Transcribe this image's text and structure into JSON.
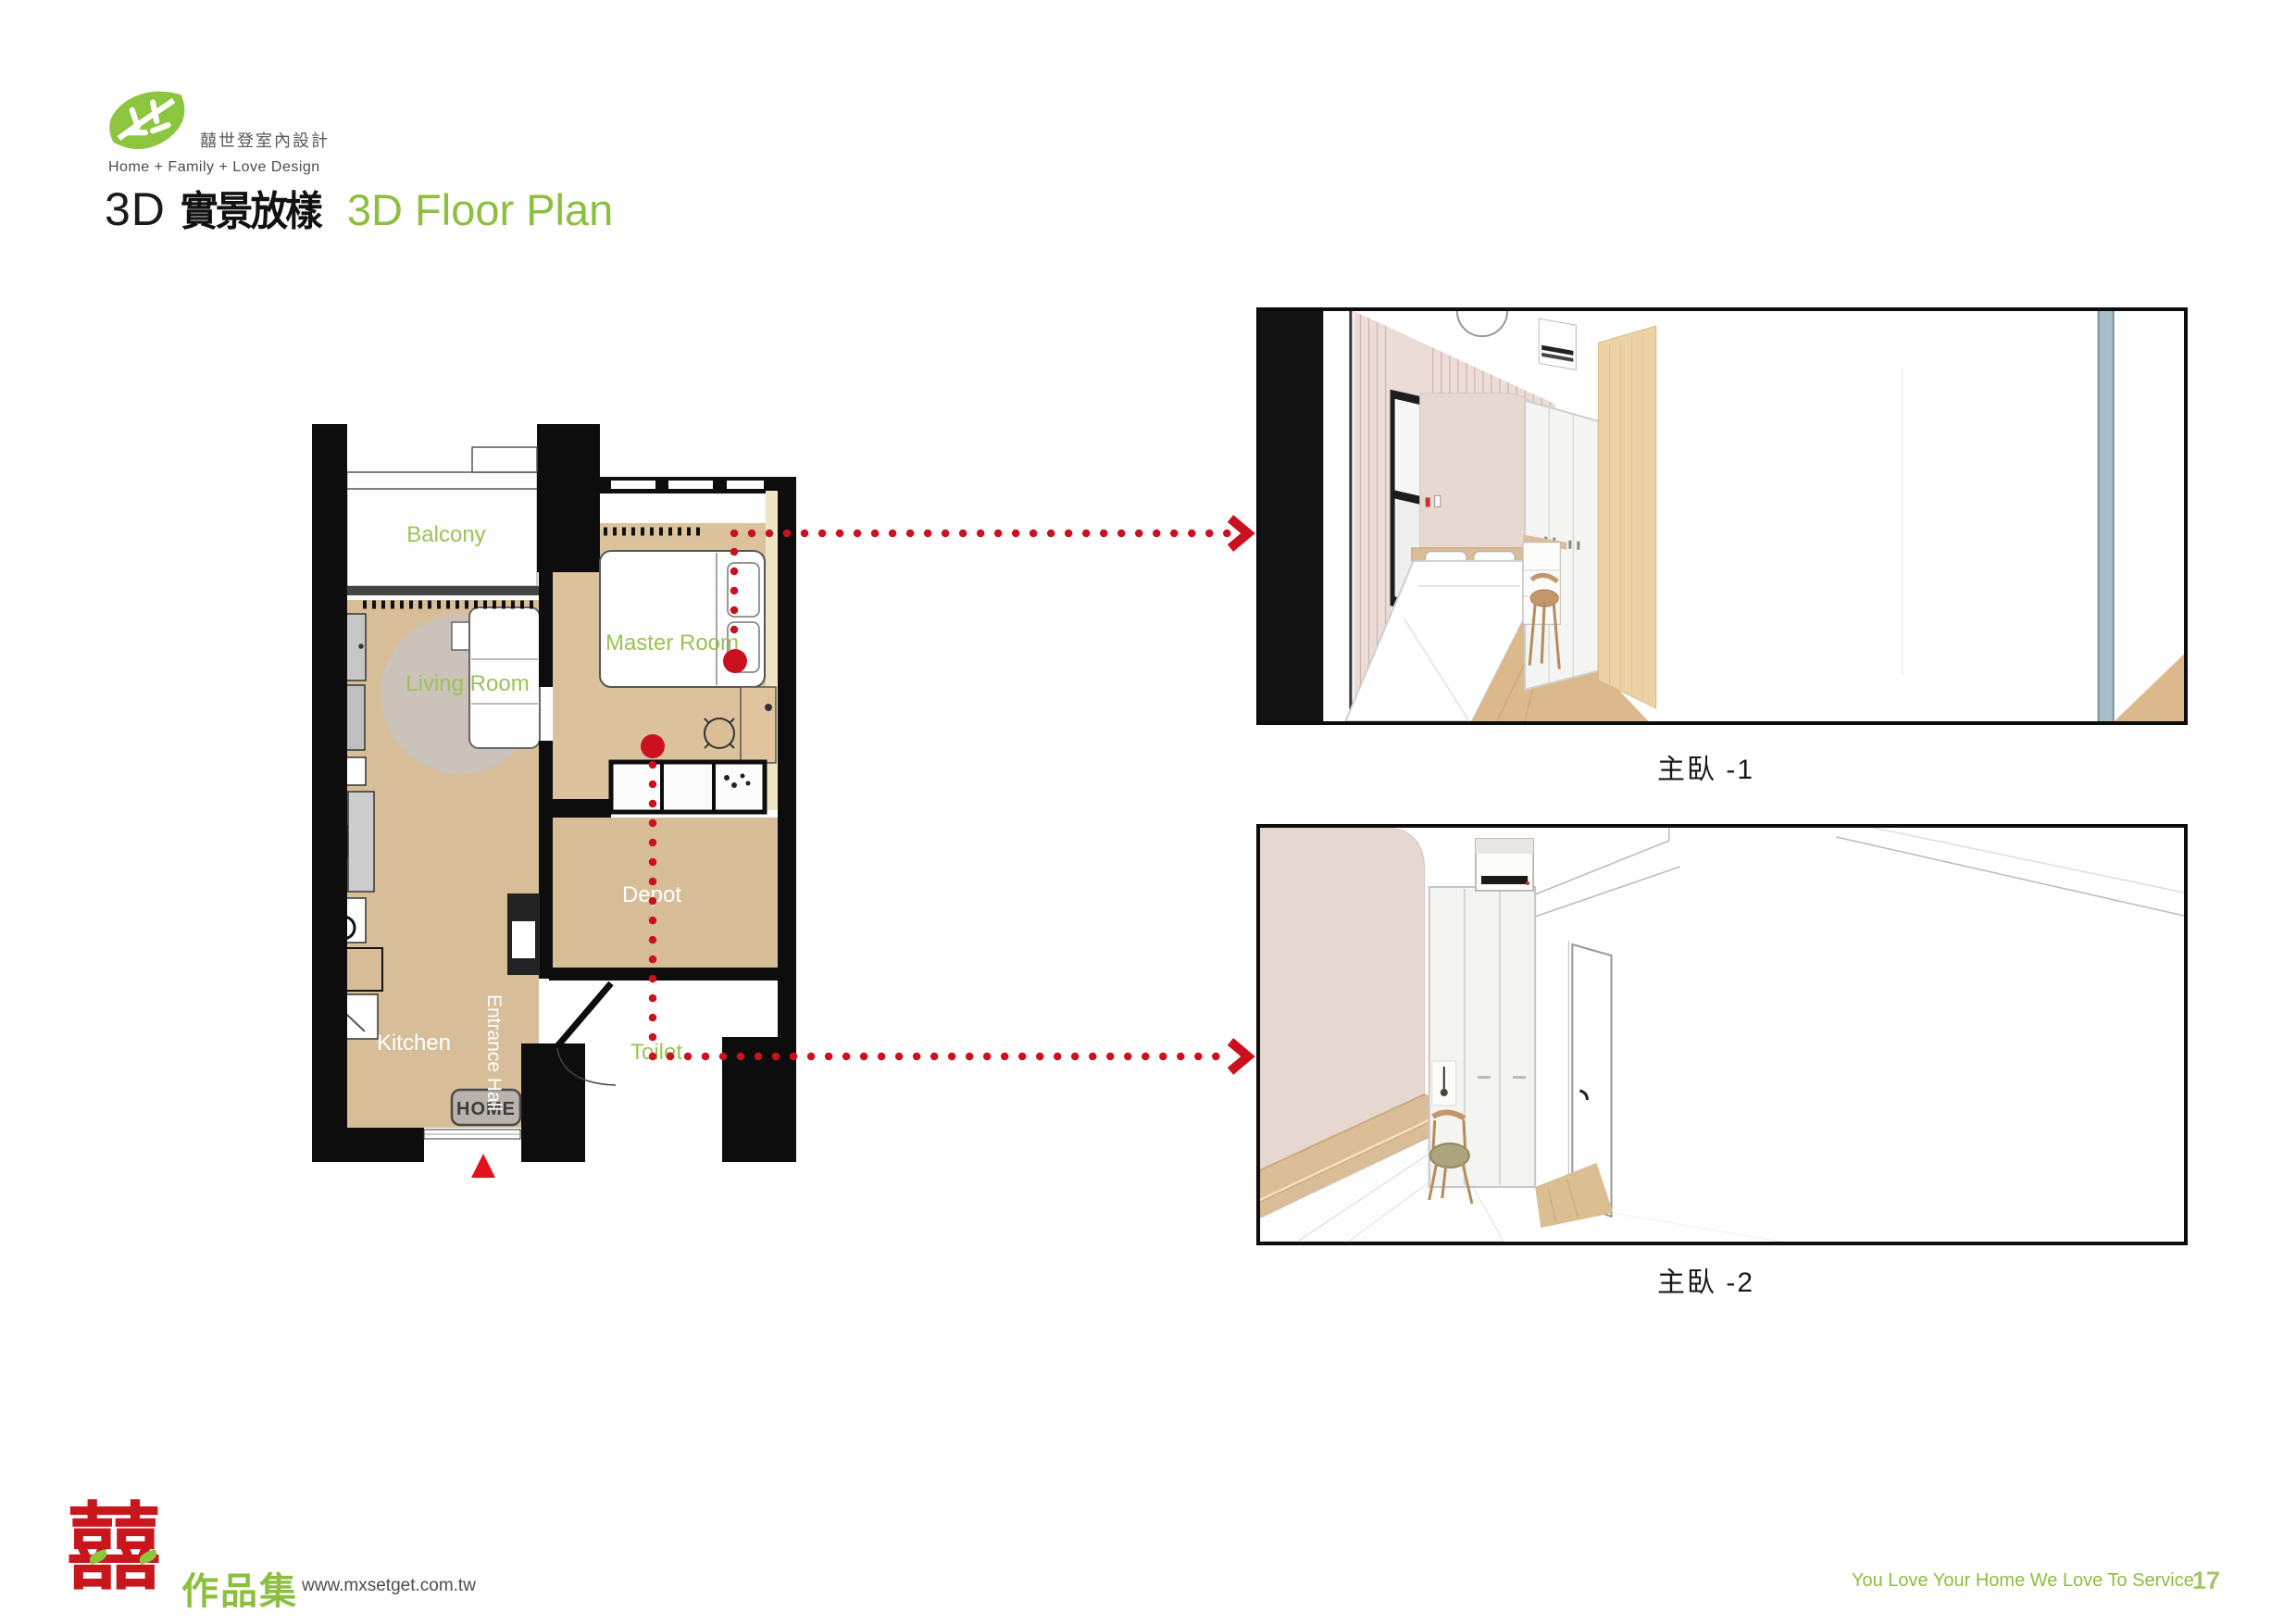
{
  "page": {
    "background": "#FFFFFF"
  },
  "header": {
    "logo_icon": "leaf-icon",
    "brand_green": "#8CC63F",
    "company_name": "囍世登室內設計",
    "tagline": "Home + Family + Love Design",
    "title_prefix": "3D",
    "title_zh": "實景放樣",
    "title_en": "3D Floor Plan",
    "title_en_color": "#8CBF3F"
  },
  "floor_plan": {
    "rooms": [
      {
        "label": "Balcony",
        "label_color": "#9BC356"
      },
      {
        "label": "Living Room",
        "label_color": "#9BC356"
      },
      {
        "label": "Master Room",
        "label_color": "#9BC356"
      },
      {
        "label": "Kitchen",
        "label_color": "#FFFFFF"
      },
      {
        "label": "Depot",
        "label_color": "#FFFFFF"
      },
      {
        "label": "Toilet",
        "label_color": "#9BC356"
      },
      {
        "label": "Entrance Hall",
        "label_color": "#FFFFFF"
      }
    ],
    "doormat_text": "HOME",
    "annotation_color": "#CB1120",
    "entrance_marker": "red-triangle-up"
  },
  "renders": [
    {
      "caption": "主臥 -1"
    },
    {
      "caption": "主臥 -2"
    }
  ],
  "footer": {
    "logo_character": "囍",
    "logo_color": "#C8161D",
    "portfolio_label": "作品集",
    "website": "www.mxsetget.com.tw",
    "slogan": "You Love Your Home We Love To Service",
    "page_number": "17"
  }
}
